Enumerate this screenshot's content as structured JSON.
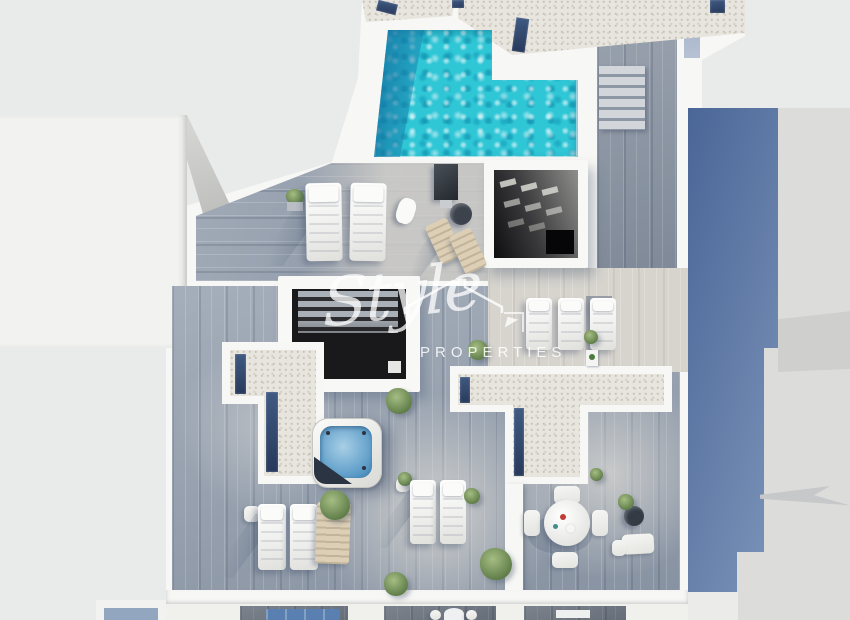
{
  "scene": {
    "description": "Aerial 3D render of a penthouse rooftop solarium: L-shaped turquoise pool, grey wood-plank sun terraces, gravel roof sections with navy strips, two skylight voids, square hot tub, white sun loungers, beige deck chairs, round outdoor dining set and potted plants; neighbouring buildings and a long blue cast shadow at right; lower-floor balconies visible at the bottom edge",
    "watermark": {
      "brand": "Style",
      "subtitle": "PROPERTIES",
      "icon": "house-roof-outline"
    },
    "objects": {
      "pool": "L-shaped pool with turquoise rippled water, darker deep end at left",
      "hot_tub": "square spa, blue water, folded navy cover corner",
      "skylights": 2,
      "sun_loungers_white": 9,
      "deck_chairs_beige": 2,
      "dining_set": "round white table with 4 chairs",
      "stairs": "wood stair run on upper right walkway"
    },
    "palette": {
      "background": "#e9eaea",
      "walls_white": "#f6f6f4",
      "pool_water": "#2fc8d7",
      "pool_deep_water": "#1a7eb0",
      "wood_deck": "#96a1af",
      "light_deck": "#d7d4ce",
      "gravel_roof": "#e8e5de",
      "roof_strip_navy": "#31476b",
      "cast_shadow_blue": "#5c79a3",
      "hot_tub_water": "#6ea6cc",
      "plants_green": "#6b8855",
      "sofa_blue": "#5a80b2"
    }
  }
}
